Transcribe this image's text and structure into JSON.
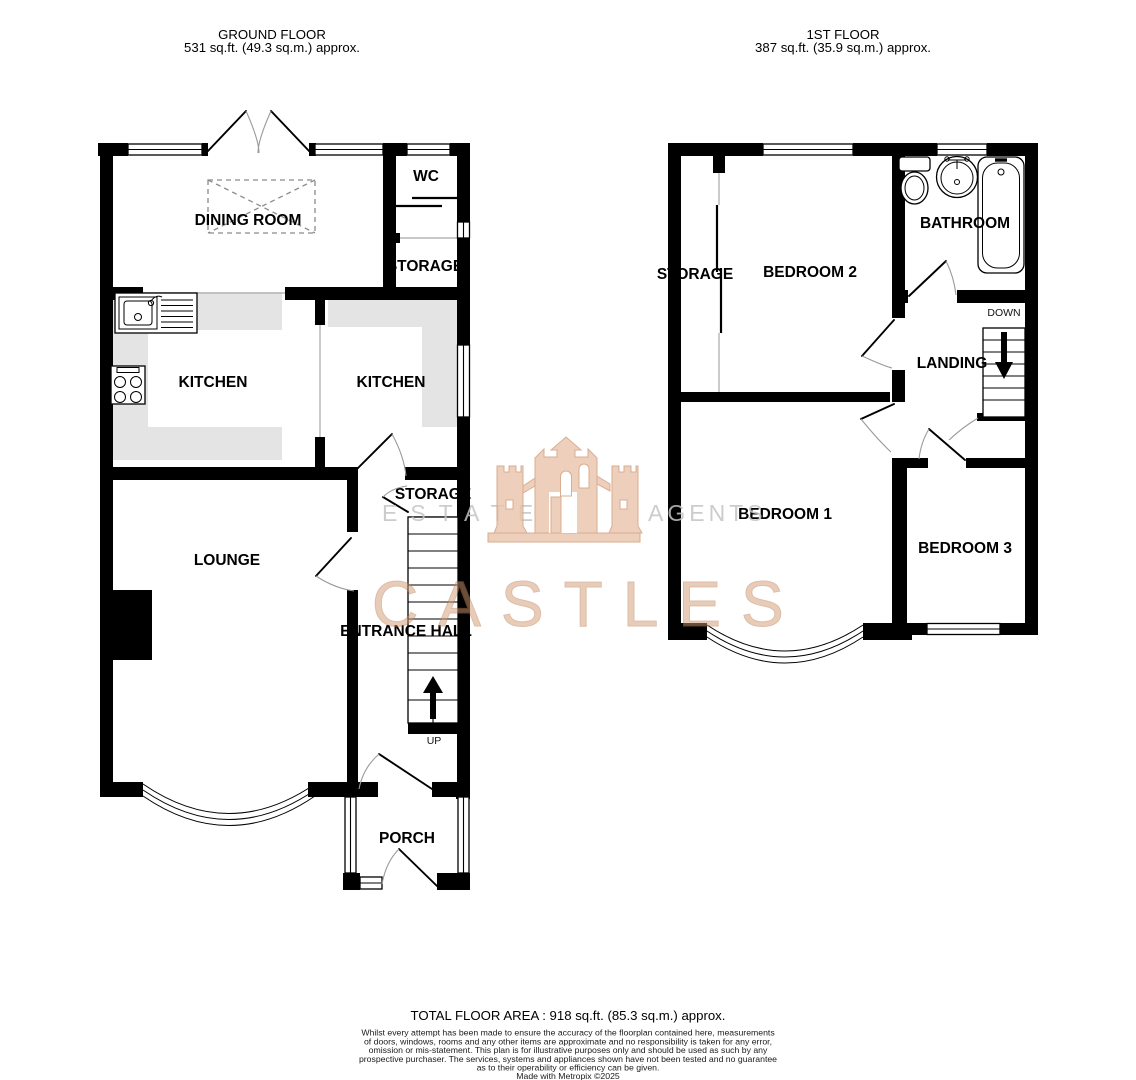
{
  "ground_floor": {
    "title": "GROUND FLOOR",
    "area": "531 sq.ft. (49.3 sq.m.) approx.",
    "labels": {
      "dining_room": "DINING ROOM",
      "wc": "WC",
      "storage_upper": "STORAGE",
      "kitchen_left": "KITCHEN",
      "kitchen_right": "KITCHEN",
      "storage_understairs": "STORAGE",
      "lounge": "LOUNGE",
      "entrance_hall": "ENTRANCE HALL",
      "up": "UP",
      "porch": "PORCH"
    }
  },
  "first_floor": {
    "title": "1ST FLOOR",
    "area": "387 sq.ft. (35.9 sq.m.) approx.",
    "labels": {
      "storage": "STORAGE",
      "bedroom2": "BEDROOM 2",
      "bathroom": "BATHROOM",
      "down": "DOWN",
      "landing": "LANDING",
      "bedroom1": "BEDROOM 1",
      "bedroom3": "BEDROOM 3"
    }
  },
  "watermark": {
    "estate": "ESTATE",
    "agents": "AGENTS",
    "brand": "CASTLES",
    "brand_color": "#d39b72",
    "text_color": "#c4c4c4"
  },
  "footer": {
    "total_area": "TOTAL FLOOR AREA : 918 sq.ft. (85.3 sq.m.) approx.",
    "disclaimer": [
      "Whilst every attempt has been made to ensure the accuracy of the floorplan contained here, measurements",
      "of doors, windows, rooms and any other items are approximate and no responsibility is taken for any error,",
      "omission or mis-statement. This plan is for illustrative purposes only and should be used as such by any",
      "prospective purchaser. The services, systems and appliances shown have not been tested and no guarantee",
      "as to their operability or efficiency can be given.",
      "Made with Metropix ©2025"
    ]
  }
}
